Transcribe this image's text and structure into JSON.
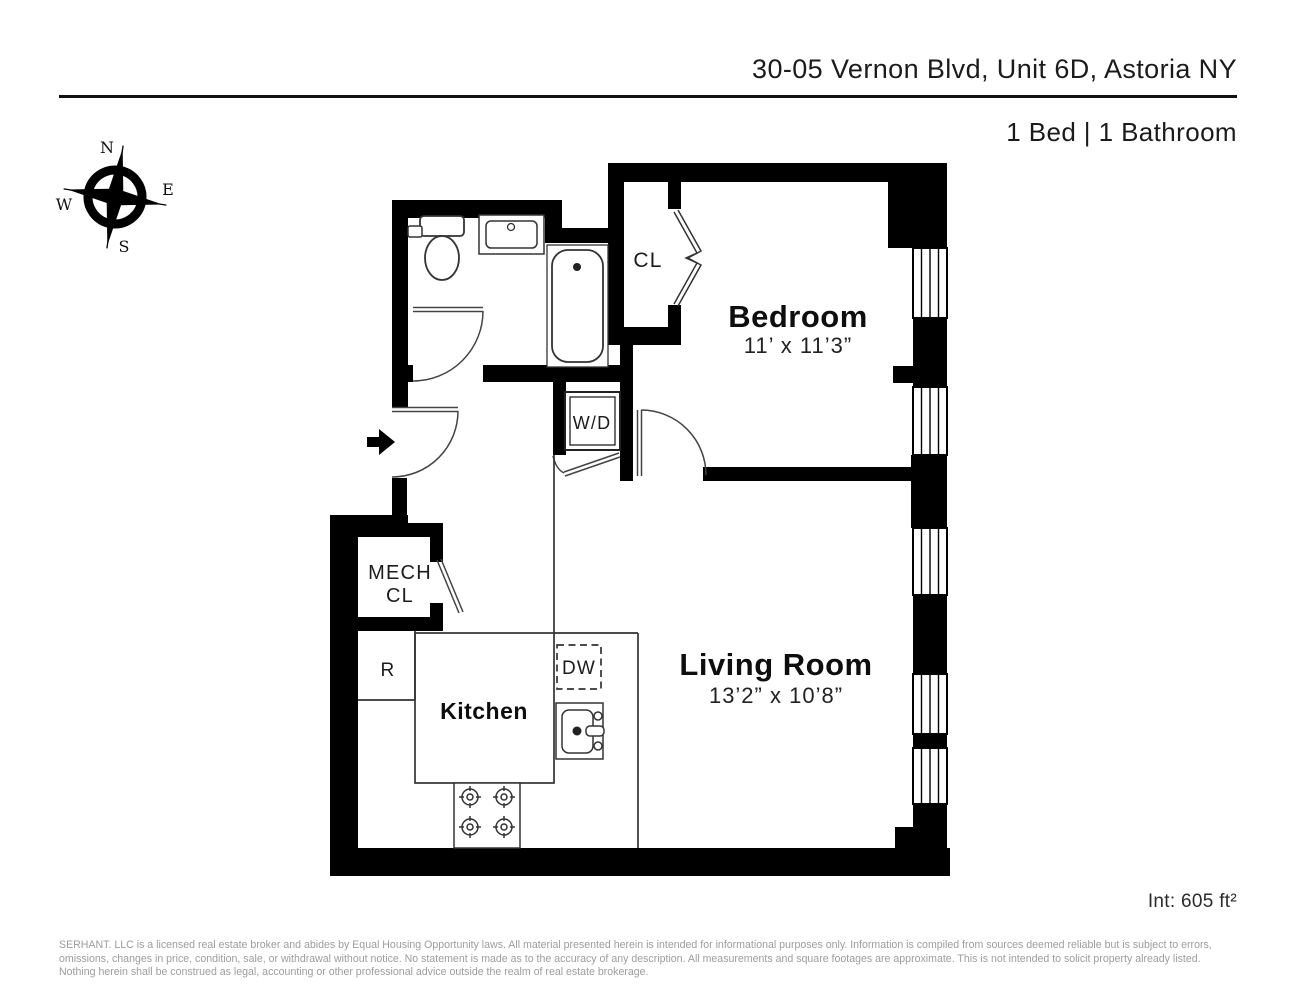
{
  "header": {
    "title": "30-05 Vernon Blvd, Unit 6D, Astoria NY",
    "subtitle": "1 Bed | 1 Bathroom"
  },
  "compass": {
    "north": "N",
    "east": "E",
    "south": "S",
    "west": "W"
  },
  "rooms": {
    "bedroom": {
      "name": "Bedroom",
      "dims": "11’ x 11’3”"
    },
    "living_room": {
      "name": "Living Room",
      "dims": "13’2” x 10’8”"
    },
    "kitchen": {
      "name": "Kitchen"
    },
    "mech_closet": {
      "line1": "MECH",
      "line2": "CL"
    },
    "closet": {
      "label": "CL"
    },
    "washer_dryer": {
      "label": "W/D"
    },
    "dishwasher": {
      "label": "DW"
    },
    "refrigerator": {
      "label": "R"
    }
  },
  "footer": {
    "area": "Int: 605 ft²",
    "disclaimer": "SERHANT. LLC is a licensed real estate broker and abides by Equal Housing Opportunity laws. All material presented herein is intended for informational purposes only. Information is compiled from sources deemed reliable but is subject to errors, omissions, changes in price, condition, sale, or withdrawal without notice. No statement is made as to the accuracy of any description. All measurements and square footages are approximate. This is not intended to solicit property already listed. Nothing herein shall be construed as legal, accounting or other professional advice outside the realm of real estate brokerage."
  }
}
